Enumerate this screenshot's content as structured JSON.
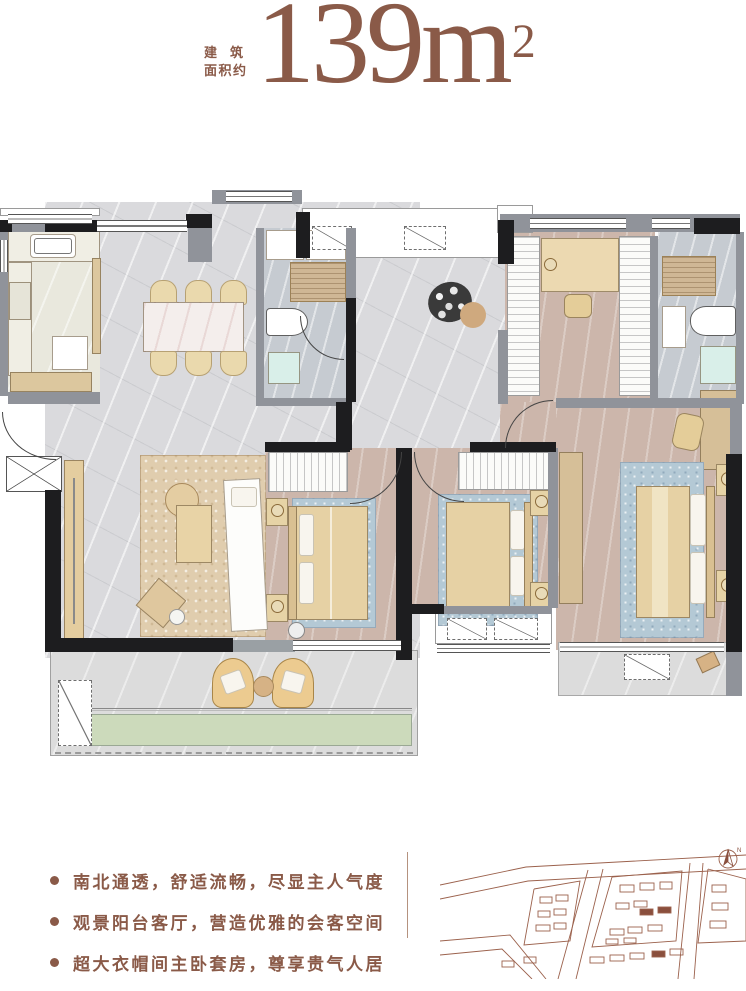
{
  "header": {
    "area_label_line1": "建筑",
    "area_label_line2": "面积约",
    "area_value": "139",
    "area_unit": "m",
    "area_exponent": "2"
  },
  "features": {
    "items": [
      "南北通透，舒适流畅，尽显主人气度",
      "观景阳台客厅，营造优雅的会客空间",
      "超大衣帽间主卧套房，尊享贵气人居"
    ]
  },
  "icons": {
    "compass": "north-arrow-compass",
    "compass_letter": "N"
  },
  "colors": {
    "accent_brown": "#8a5a48",
    "siteplan_line": "#9b614c",
    "wall_black": "#1d1d1f",
    "wall_gray": "#90939a",
    "floor_marble": "#dadadd",
    "floor_wood": "#ccb6ab",
    "floor_kitchen": "#e9e8dd",
    "floor_bath": "#c6cbd1",
    "bed_beige": "#e6d1a4",
    "rug_blue": "#b4c9d5",
    "rug_beige": "#e0cdae",
    "planter_green": "#ccdabb"
  }
}
